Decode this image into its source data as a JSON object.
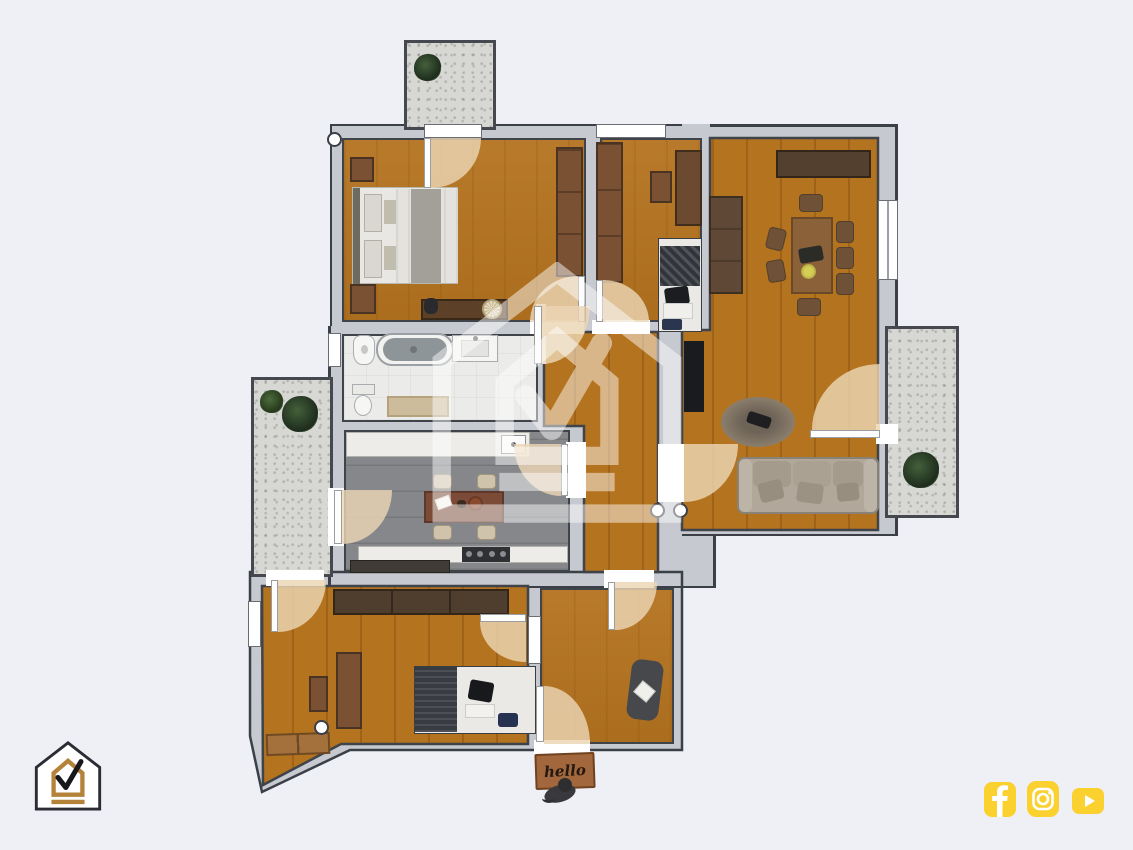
{
  "floorplan": {
    "doormat_text": "hello",
    "colors": {
      "background": "#eef0f5",
      "wall_fill": "#c6c9cf",
      "wall_outline": "#3b3f46",
      "wood_floor": "#b4731f",
      "kitchen_floor": "#85878a",
      "bathroom_floor": "#ebebe9",
      "balcony_floor": "#d7d8d4",
      "door_swing_arc": "#ecd6b5"
    }
  },
  "branding": {
    "watermark_name": "house-check-watermark",
    "logo_name": "house-check-logo",
    "logo_colors": {
      "outline": "#2c2c34",
      "gold": "#b5823a",
      "check": "#17171c"
    },
    "social_accent": "#fbd130",
    "social": [
      {
        "name": "facebook"
      },
      {
        "name": "instagram"
      },
      {
        "name": "youtube"
      }
    ]
  }
}
